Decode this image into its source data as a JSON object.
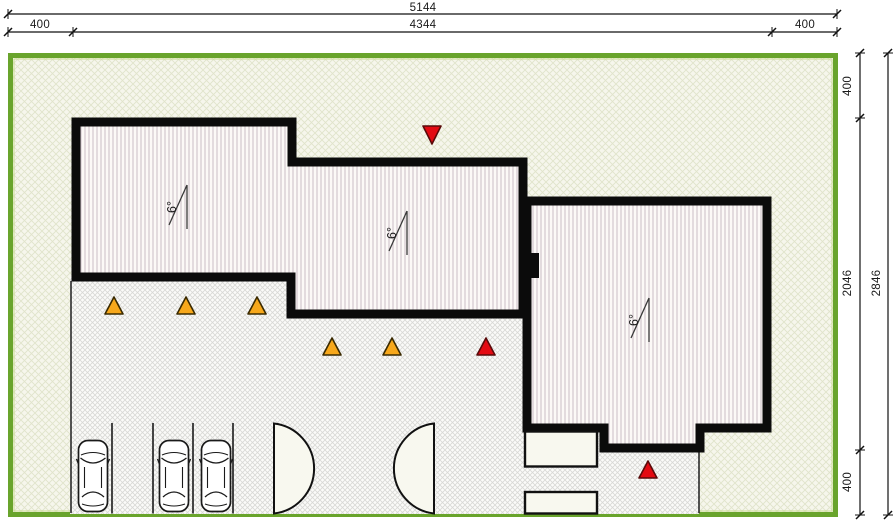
{
  "drawing": {
    "title": "site-plan",
    "dimensions_top": {
      "total": "5144",
      "left_offset": "400",
      "building_width": "4344",
      "right_offset": "400"
    },
    "dimensions_right": {
      "top_offset": "400",
      "building_height": "2046",
      "bottom_offset": "400",
      "total": "2846"
    },
    "roof_slope_label": "6°",
    "site": {
      "border_color": "#69A42C"
    },
    "markers": {
      "yellow_color": "#F7A81B",
      "red_color": "#E30A12",
      "yellow_up_count": 5,
      "red_up_count": 2,
      "red_down_count": 1
    },
    "parking": {
      "car_count": 3,
      "bay_count": 4
    },
    "door_count": 2
  }
}
